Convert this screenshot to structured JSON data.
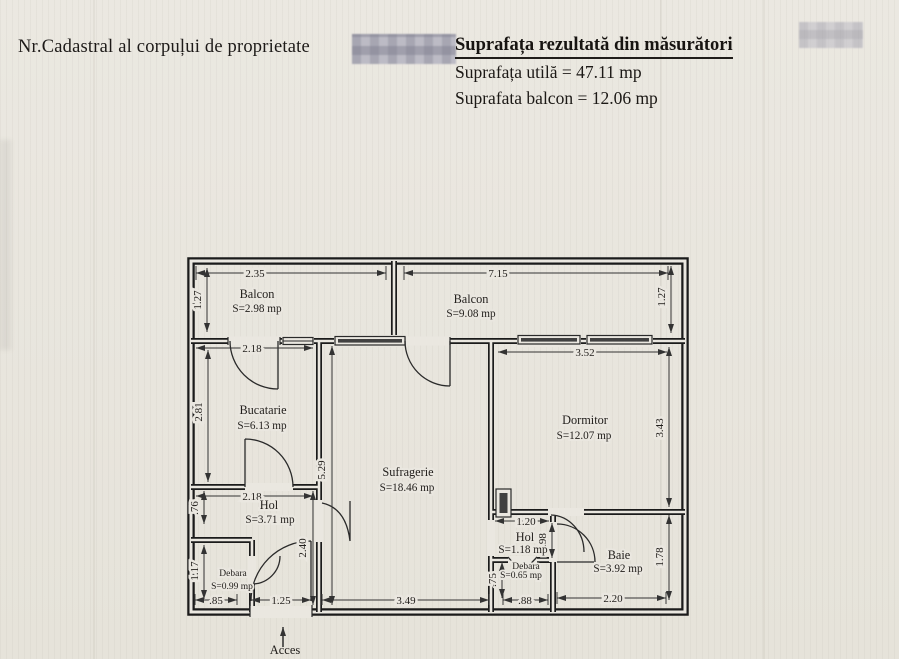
{
  "header": {
    "cadastral_label": "Nr.Cadastral al corpuļui de proprietate",
    "title": "Suprafața rezultată din măsurători",
    "usable_area": "Suprafața utilă = 47.11 mp",
    "balcony_area": "Suprafata balcon = 12.06 mp"
  },
  "plan": {
    "rooms": [
      {
        "name": "Balcon",
        "area": "S=2.98 mp"
      },
      {
        "name": "Balcon",
        "area": "S=9.08 mp"
      },
      {
        "name": "Bucatarie",
        "area": "S=6.13 mp"
      },
      {
        "name": "Sufragerie",
        "area": "S=18.46 mp"
      },
      {
        "name": "Dormitor",
        "area": "S=12.07 mp"
      },
      {
        "name": "Hol",
        "area": "S=3.71 mp"
      },
      {
        "name": "Debara",
        "area": "S=0.99 mp"
      },
      {
        "name": "Hol",
        "area": "S=1.18 mp"
      },
      {
        "name": "Debara",
        "area": "S=0.65 mp"
      },
      {
        "name": "Baie",
        "area": "S=3.92 mp"
      }
    ],
    "dims": {
      "balcony_left_w": "2.35",
      "balcony_left_h": "1.27",
      "balcony_right_w": "7.15",
      "balcony_right_h": "1.27",
      "bucatarie_w": "2.18",
      "bucatarie_h": "2.81",
      "dormitor_w": "3.52",
      "dormitor_h": "3.43",
      "sufragerie_h": "5.29",
      "hol_w": "2.18",
      "hol_h": ".76",
      "corridor_h": "2.40",
      "debara_h": "1.17",
      "debara_w": ".85",
      "entrance_w": "1.25",
      "sufragerie_w": "3.49",
      "hol2_w": "1.20",
      "hol2_h": ".98",
      "debara2_h": ".75",
      "debara2_w": ".88",
      "baie_w": "2.20",
      "baie_h": "1.78"
    },
    "access_label": "Acces"
  }
}
